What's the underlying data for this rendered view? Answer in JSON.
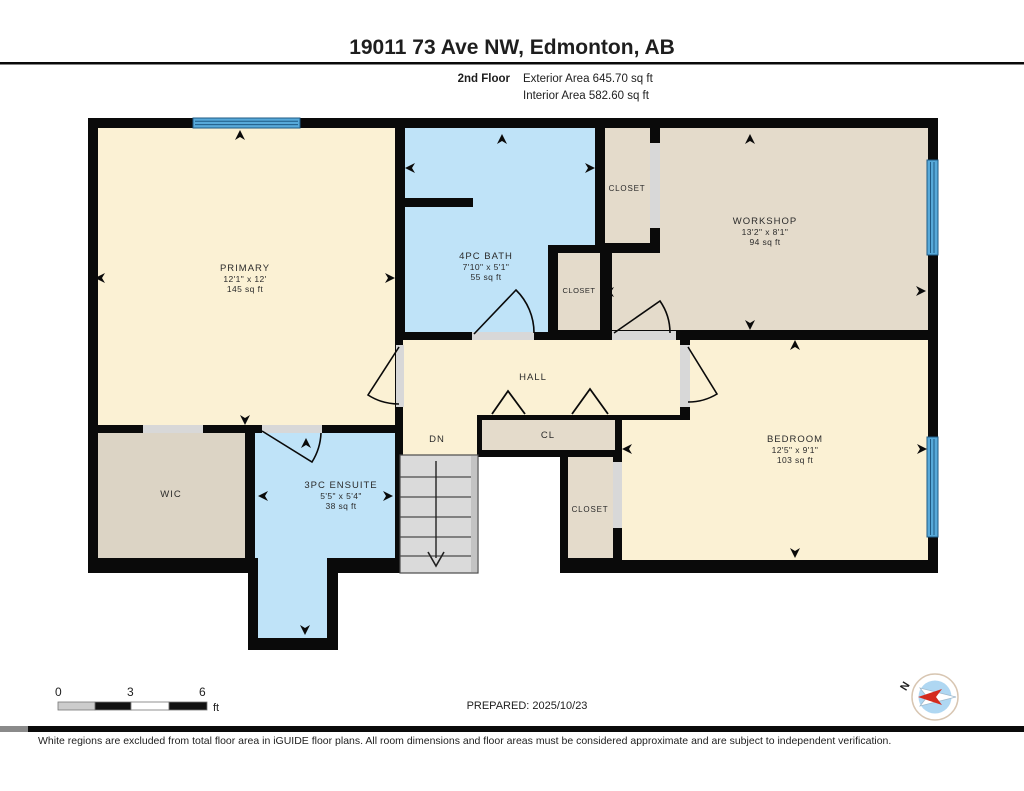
{
  "header": {
    "title": "19011 73 Ave NW, Edmonton, AB",
    "floor_label": "2nd Floor",
    "exterior_area": "Exterior Area 645.70 sq ft",
    "interior_area": "Interior Area 582.60 sq ft"
  },
  "rooms": {
    "primary": {
      "name": "PRIMARY",
      "dims": "12'1\" x 12'",
      "area": "145 sq ft"
    },
    "bath": {
      "name": "4PC BATH",
      "dims": "7'10\" x 5'1\"",
      "area": "55 sq ft"
    },
    "workshop": {
      "name": "WORKSHOP",
      "dims": "13'2\" x 8'1\"",
      "area": "94 sq ft"
    },
    "bedroom": {
      "name": "BEDROOM",
      "dims": "12'5\" x 9'1\"",
      "area": "103 sq ft"
    },
    "ensuite": {
      "name": "3PC ENSUITE",
      "dims": "5'5\" x 5'4\"",
      "area": "38 sq ft"
    },
    "wic": {
      "name": "WIC"
    },
    "hall": {
      "name": "HALL"
    },
    "stairs": {
      "name": "DN"
    },
    "closet_hall": {
      "name": "CL"
    },
    "closet_bath_top": {
      "name": "CLOSET"
    },
    "closet_bath_mid": {
      "name": "CLOSET"
    },
    "closet_bedroom": {
      "name": "CLOSET"
    }
  },
  "scale_bar": {
    "tick0": "0",
    "tick1": "3",
    "tick2": "6",
    "unit": "ft"
  },
  "footer": {
    "prepared": "PREPARED: 2025/10/23",
    "compass_north": "N",
    "disclaimer": "White regions are excluded from total floor area in iGUIDE floor plans. All room dimensions and floor areas must be considered approximate and are subject to independent verification."
  },
  "colors": {
    "room_cream": "#FBF1D4",
    "room_tan": "#E4DBCB",
    "room_wic": "#DCD4C5",
    "room_blue": "#BFE3F8",
    "window_blue": "#57A9D9",
    "wall_black": "#0A0A0A",
    "opening_grey": "#D8D8D8",
    "stairs_grey": "#DADADA",
    "compass_red": "#D42B1E",
    "compass_inner": "#AFD7F2"
  }
}
